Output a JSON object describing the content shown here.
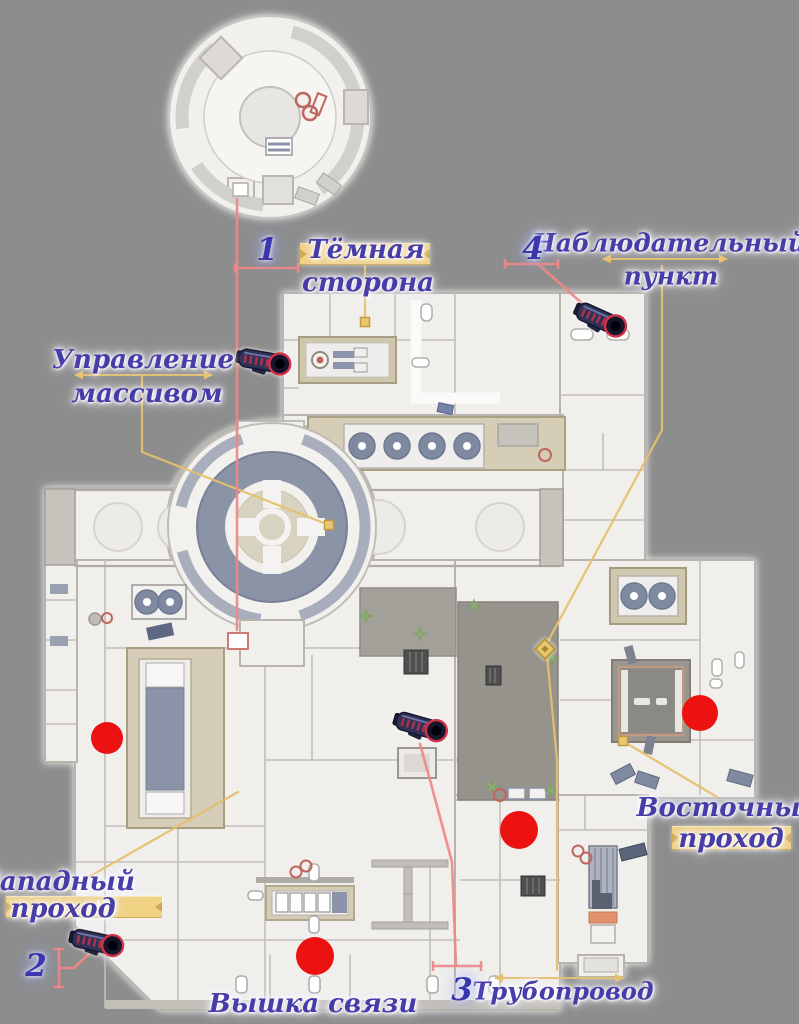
{
  "scene": {
    "width": 799,
    "height": 1024,
    "background": "#8d8d8d"
  },
  "colors": {
    "label_text": "#473da8",
    "number_text": "#3b36ad",
    "bar_fill": "#f0d285",
    "bar_edge": "#cfa852",
    "bar_letter": "#ffffff",
    "connector_yellow": "#e5c06b",
    "connector_red": "#ee8888",
    "marker_red": "#ed1212",
    "diamond_fill": "#e9c76f"
  },
  "area_labels": [
    {
      "id": "dark-side",
      "size": 26,
      "lines": [
        {
          "text": "Тёмная",
          "x": 366,
          "y": 250
        },
        {
          "text": "сторона",
          "x": 368,
          "y": 283
        }
      ],
      "bar": {
        "x": 300,
        "y": 243,
        "w": 130,
        "h": 20
      }
    },
    {
      "id": "observation-point",
      "size": 25,
      "lines": [
        {
          "text": "Наблюдательный",
          "x": 669,
          "y": 243
        },
        {
          "text": "пункт",
          "x": 671,
          "y": 276
        }
      ]
    },
    {
      "id": "array-control",
      "size": 26,
      "lines": [
        {
          "text": "Управление",
          "x": 143,
          "y": 360
        },
        {
          "text": "массивом",
          "x": 147,
          "y": 394
        }
      ]
    },
    {
      "id": "west-passage",
      "size": 26,
      "lines": [
        {
          "text": "Западный",
          "x": 58,
          "y": 882
        },
        {
          "text": "проход",
          "x": 63,
          "y": 909
        }
      ],
      "bar": {
        "x": 6,
        "y": 896,
        "w": 156,
        "h": 20,
        "letter": "Н",
        "letter_x": 90
      }
    },
    {
      "id": "east-passage",
      "size": 26,
      "lines": [
        {
          "text": "Восточный",
          "x": 728,
          "y": 808
        },
        {
          "text": "проход",
          "x": 731,
          "y": 839
        }
      ],
      "bar": {
        "x": 672,
        "y": 826,
        "w": 119,
        "h": 22,
        "letter": "Н",
        "letter_x": 99
      }
    },
    {
      "id": "comm-tower",
      "size": 26,
      "lines": [
        {
          "text": "Вышка связи",
          "x": 313,
          "y": 1004
        }
      ]
    },
    {
      "id": "pipeline",
      "size": 24,
      "lines": [
        {
          "text": "Трубопровод",
          "x": 563,
          "y": 991
        }
      ]
    }
  ],
  "number_markers": [
    {
      "value": "1",
      "x": 267,
      "y": 250
    },
    {
      "value": "2",
      "x": 36,
      "y": 966
    },
    {
      "value": "3",
      "x": 462,
      "y": 990
    },
    {
      "value": "4",
      "x": 533,
      "y": 249
    }
  ],
  "red_dots": [
    {
      "x": 107,
      "y": 738,
      "r": 16
    },
    {
      "x": 700,
      "y": 713,
      "r": 18
    },
    {
      "x": 519,
      "y": 830,
      "r": 19
    },
    {
      "x": 315,
      "y": 956,
      "r": 19
    }
  ],
  "weapon_markers": [
    {
      "x": 263,
      "y": 361,
      "angle": 10
    },
    {
      "x": 600,
      "y": 319,
      "angle": 24
    },
    {
      "x": 420,
      "y": 726,
      "angle": 16
    },
    {
      "x": 96,
      "y": 942,
      "angle": 12
    }
  ],
  "connectors": {
    "yellow": [
      {
        "points": [
          [
            365,
            263
          ],
          [
            365,
            318
          ]
        ],
        "end_square": [
          365,
          322
        ]
      },
      {
        "points": [
          [
            142,
            376
          ],
          [
            142,
            452
          ],
          [
            329,
            525
          ]
        ],
        "end_square": [
          329,
          525
        ]
      },
      {
        "points": [
          [
            662,
            266
          ],
          [
            662,
            430
          ],
          [
            546,
            645
          ]
        ]
      },
      {
        "points": [
          [
            547,
            655
          ],
          [
            557,
            760
          ],
          [
            557,
            970
          ]
        ]
      },
      {
        "points": [
          [
            717,
            797
          ],
          [
            626,
            743
          ]
        ],
        "end_square": [
          623,
          741
        ]
      },
      {
        "points": [
          [
            64,
            891
          ],
          [
            238,
            792
          ]
        ]
      }
    ],
    "yellow_dimlines": [
      {
        "x1": 603,
        "x2": 727,
        "y": 259
      },
      {
        "x1": 75,
        "x2": 212,
        "y": 375
      },
      {
        "x1": 495,
        "x2": 623,
        "y": 978
      }
    ],
    "red": [
      {
        "points": [
          [
            237,
            199
          ],
          [
            237,
            630
          ]
        ]
      },
      {
        "points": [
          [
            235,
            268
          ],
          [
            298,
            268
          ]
        ],
        "ticks": true
      },
      {
        "points": [
          [
            505,
            264
          ],
          [
            558,
            264
          ]
        ],
        "ticks": true
      },
      {
        "points": [
          [
            538,
            264
          ],
          [
            594,
            314
          ]
        ]
      },
      {
        "points": [
          [
            59,
            949
          ],
          [
            59,
            987
          ]
        ],
        "ticks": true
      },
      {
        "points": [
          [
            59,
            968
          ],
          [
            74,
            968
          ],
          [
            92,
            951
          ]
        ]
      },
      {
        "points": [
          [
            420,
            744
          ],
          [
            430,
            780
          ],
          [
            452,
            862
          ],
          [
            456,
            966
          ]
        ]
      },
      {
        "points": [
          [
            433,
            966
          ],
          [
            481,
            966
          ]
        ],
        "ticks": true
      }
    ],
    "diamond": [
      545,
      649
    ]
  }
}
